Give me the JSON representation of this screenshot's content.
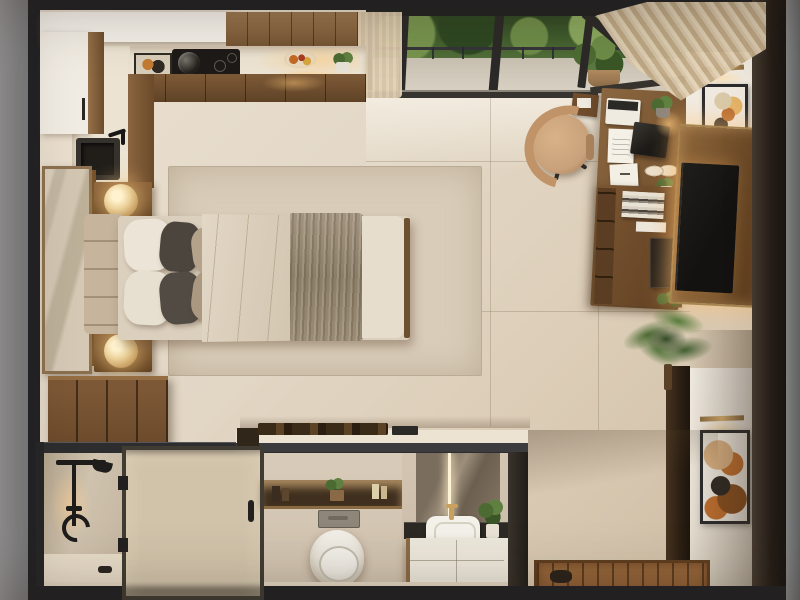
{
  "scene": {
    "description": "Photorealistic top-down (dollhouse cutaway) 3D render of a studio apartment",
    "view": "bird's-eye plan view with sectioned bathroom at bottom",
    "rooms": [
      "kitchen",
      "bedroom",
      "home-office",
      "tv-wall",
      "bathroom",
      "entry",
      "balcony"
    ]
  },
  "objects": [
    {
      "name": "kitchen-upper-cabinets",
      "description": "walnut upper cabinet run along top wall"
    },
    {
      "name": "kitchen-counter",
      "description": "light stone counter with framed art, cooktop with pot, fruit bowl, potted herb, under-cabinet lighting"
    },
    {
      "name": "kitchen-sink",
      "description": "dark undermount sink with black faucet on left counter"
    },
    {
      "name": "tall-white-cabinet",
      "description": "white tall unit in top-left corner"
    },
    {
      "name": "balcony",
      "description": "glazed wall with sliding doors, dark railing, green tree canopy, potted plant"
    },
    {
      "name": "curtains",
      "description": "sheer beige curtains at both ends of the window wall"
    },
    {
      "name": "bed",
      "description": "double bed with channel-tufted headboard, white/charcoal/taupe pillows, beige duvet, gray-brown throw"
    },
    {
      "name": "nightstands",
      "description": "two walnut nightstands with glowing brass dome lamps"
    },
    {
      "name": "wardrobe-door",
      "description": "tall framed panel on left wall"
    },
    {
      "name": "dresser",
      "description": "four-door walnut dresser below bed"
    },
    {
      "name": "area-rug",
      "description": "large beige rug under bed"
    },
    {
      "name": "desk",
      "description": "walnut desk with laptop, white keypad, papers, plants, breakfast plates, warm lamp"
    },
    {
      "name": "office-chair",
      "description": "tan swivel chair with black five-star base"
    },
    {
      "name": "shelf-unit",
      "description": "desk-side shelving with books, black cabinet, plants"
    },
    {
      "name": "tv-wall",
      "description": "backlit walnut media panel with wall-mounted TV"
    },
    {
      "name": "tall-plant",
      "description": "leafy floor plant beside TV wall"
    },
    {
      "name": "wall-art",
      "description": "two framed abstract artworks with brass picture lights on right wall"
    },
    {
      "name": "bathroom-shower",
      "description": "shower with black fixtures and frosted glass partition"
    },
    {
      "name": "bathroom-niche",
      "description": "backlit niche shelf with bottles and plant"
    },
    {
      "name": "toilet",
      "description": "white wall-hung toilet with gray flush plate"
    },
    {
      "name": "vanity",
      "description": "LED-lit mirror, dark counter, white vessel sink, gold faucet, white drawers"
    },
    {
      "name": "kitchen-peninsula",
      "description": "counter with dark wood boards atop bathroom volume"
    },
    {
      "name": "entry-mat",
      "description": "slatted wood entry mat with dark slippers"
    }
  ],
  "palette": {
    "frame-black": "#222225",
    "outer-gray": "#8e8e90",
    "floor-marble": "#e3d8c7",
    "wall-white": "#f1ece3",
    "ceiling-white": "#f4f0e9",
    "wood-cabinet": "#8a6742",
    "wood-mid": "#7a5733",
    "wood-dark": "#5f4226",
    "counter-light": "#ece3d2",
    "cooktop-black": "#1d1a17",
    "rug": "#d9cdba",
    "duvet": "#dbcfbd",
    "pillow-white": "#ece5d7",
    "pillow-dark": "#4b453e",
    "pillow-taupe": "#b4a28a",
    "headboard-tan": "#c6b49d",
    "blanket-gray": "#8b7d66",
    "lamp-gold": "#ecd29b",
    "curtain": "#d8c5a9",
    "foliage": "#44602f",
    "balcony-floor": "#dbd3c5",
    "chair-tan": "#c8a17b",
    "tv-black": "#141210",
    "tv-panel-wood": "#74512c",
    "marble-bath": "#d6c9b7",
    "toilet-white": "#f4f1ea",
    "vanity-dark": "#2d2924",
    "drawer-white": "#ece7db",
    "mat-wood": "#8a5c33",
    "art-orange": "#c2702e"
  }
}
